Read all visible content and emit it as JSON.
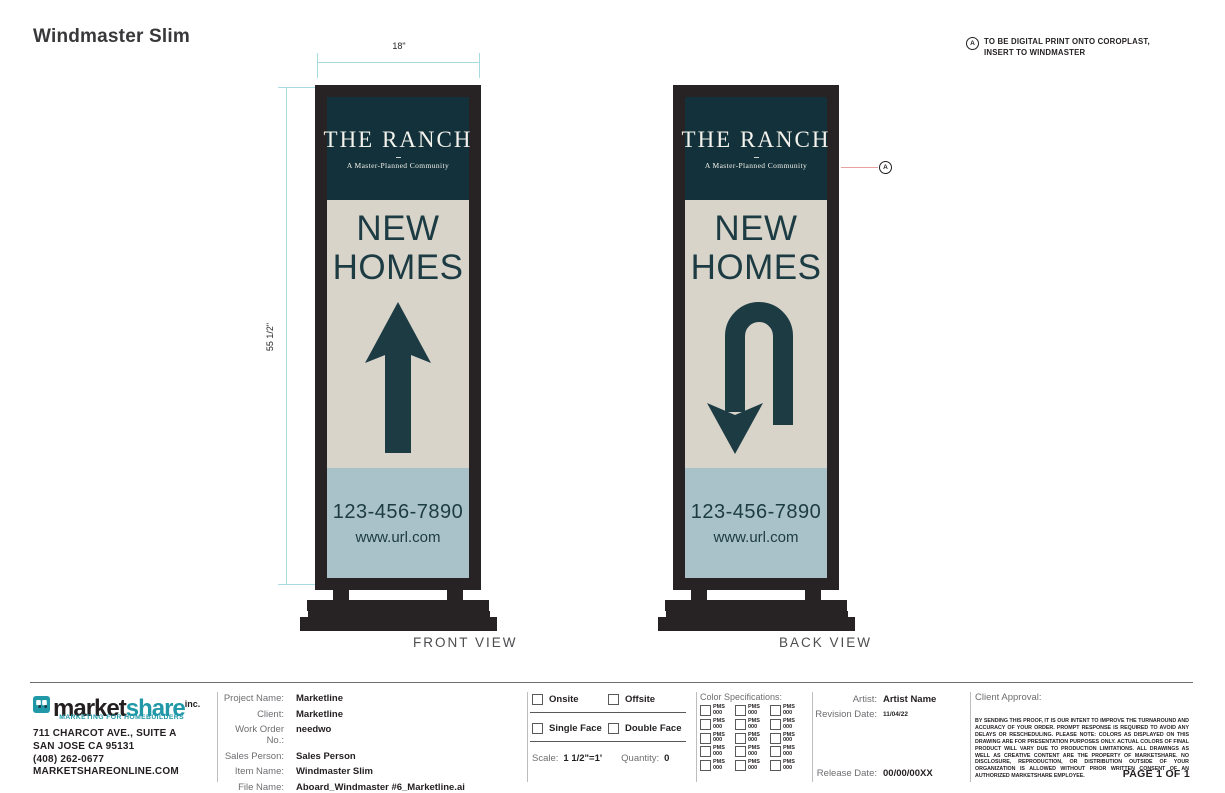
{
  "page": {
    "title": "Windmaster Slim",
    "note": {
      "marker": "A",
      "line1": "TO BE DIGITAL PRINT ONTO COROPLAST,",
      "line2": "INSERT TO WINDMASTER"
    }
  },
  "dimensions": {
    "width": "18\"",
    "height": "55 1/2\""
  },
  "sign": {
    "brand_title": "THE RANCH",
    "brand_subtitle": "A Master-Planned Community",
    "headline_line1": "NEW",
    "headline_line2": "HOMES",
    "phone": "123-456-7890",
    "url": "www.url.com"
  },
  "views": {
    "front": "FRONT VIEW",
    "back": "BACK VIEW",
    "callout_marker": "A"
  },
  "colors": {
    "frame": "#272223",
    "header_panel": "#12313a",
    "body_panel": "#d8d4ca",
    "footer_panel": "#a9c1c9",
    "sign_ink": "#1c3b43",
    "dimension_line": "#a6dbe0",
    "callout_line": "#e8a1a1",
    "brand_teal": "#2098a7",
    "ink": "#231f20",
    "label_gray": "#6d6e71"
  },
  "titleblock": {
    "company": {
      "wordmark_part1": "market",
      "wordmark_part2": "share",
      "wordmark_suffix": "inc.",
      "tagline": "MARKETING FOR HOMEBUILDERS",
      "address1": "711 CHARCOT AVE., SUITE A",
      "address2": "SAN JOSE CA 95131",
      "phone": "(408) 262-0677",
      "website": "MARKETSHAREONLINE.COM"
    },
    "project": {
      "fields": [
        {
          "label": "Project Name:",
          "value": "Marketline"
        },
        {
          "label": "Client:",
          "value": "Marketline"
        },
        {
          "label": "Work Order No.:",
          "value": "needwo"
        },
        {
          "label": "Sales Person:",
          "value": "Sales Person"
        },
        {
          "label": "Item Name:",
          "value": "Windmaster Slim"
        },
        {
          "label": "File Name:",
          "value": "Aboard_Windmaster #6_Marketline.ai"
        }
      ]
    },
    "options": {
      "onsite": "Onsite",
      "offsite": "Offsite",
      "single_face": "Single Face",
      "double_face": "Double Face",
      "scale_label": "Scale:",
      "scale_value": "1 1/2\"=1'",
      "quantity_label": "Quantity:",
      "quantity_value": "0"
    },
    "color_specs": {
      "title": "Color Specifications:",
      "swatch_line1": "PMS",
      "swatch_line2": "000",
      "rows": 5,
      "cols": 3
    },
    "approval": {
      "artist_label": "Artist:",
      "artist_value": "Artist Name",
      "revision_label": "Revision Date:",
      "revision_value": "11/04/22",
      "release_label": "Release Date:",
      "release_value": "00/00/00XX"
    },
    "client": {
      "title": "Client Approval:",
      "legal": "BY SENDING THIS PROOF, IT IS OUR INTENT TO IMPROVE THE TURNAROUND AND ACCURACY OF YOUR ORDER. PROMPT RESPONSE IS REQUIRED TO AVOID ANY DELAYS OR RESCHEDULING. PLEASE NOTE: COLORS AS DISPLAYED ON THIS DRAWING ARE FOR PRESENTATION PURPOSES ONLY. ACTUAL COLORS OF FINAL PRODUCT WILL VARY DUE TO PRODUCTION LIMITATIONS. ALL DRAWINGS AS WELL AS CREATIVE CONTENT ARE THE PROPERTY OF MARKETSHARE. NO DISCLOSURE, REPRODUCTION, OR DISTRIBUTION OUTSIDE OF YOUR ORGANIZATION IS ALLOWED WITHOUT PRIOR WRITTEN CONSENT OF AN AUTHORIZED MARKETSHARE EMPLOYEE.",
      "page_number": "PAGE 1 OF 1"
    }
  }
}
